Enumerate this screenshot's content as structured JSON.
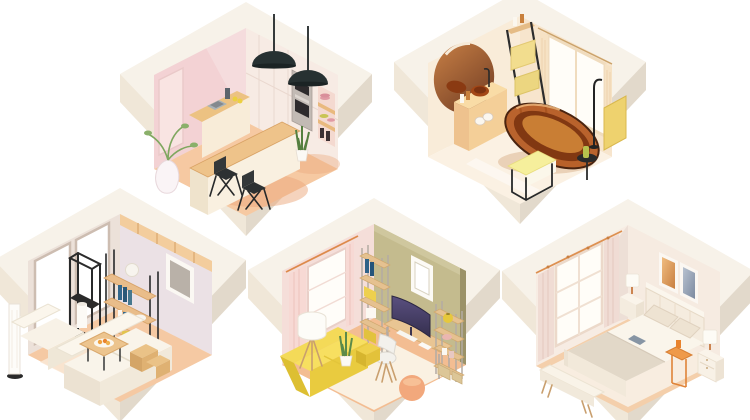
{
  "title": "Isometric hexagonal rooms illustration",
  "description": "Five low-poly isometric room interiors shown as hexagonal cut-away dioramas on a white background",
  "rooms": [
    {
      "id": "kitchen",
      "name": "Kitchen",
      "position": "top-left",
      "objects": [
        "pink-tiled-walls",
        "cream-cabinet-wall",
        "double-built-in-oven",
        "open-shelf-niche-with-plates",
        "sink-counter",
        "kitchen-island-bar",
        "black-pendant-lamps",
        "black-bar-stools",
        "white-floor-vase-with-plant",
        "potted-snake-plant"
      ]
    },
    {
      "id": "bathroom",
      "name": "Bathroom",
      "position": "top-right",
      "objects": [
        "round-mirror",
        "floating-vanity-with-amber-vessel-sink",
        "amber-glass-freestanding-bathtub",
        "black-freestanding-faucet",
        "ladder-towel-rack-with-yellow-towels",
        "bench-with-yellow-cushion",
        "window-with-cream-curtains",
        "yellow-screen-panel",
        "side-table-with-bottle"
      ]
    },
    {
      "id": "living-room",
      "name": "Living room",
      "position": "bottom-left",
      "objects": [
        "floor-to-ceiling-windows",
        "wood-plank-ceiling-band",
        "white-sectional-sofa",
        "coffee-table-with-fruit-plate",
        "black-etagere-with-vase",
        "wood-bookshelf-with-books",
        "white-column-floor-lamp",
        "wall-picture-frame",
        "wood-side-cubes",
        "rug"
      ]
    },
    {
      "id": "home-office",
      "name": "Home office",
      "position": "bottom-center",
      "objects": [
        "window-with-pink-curtains",
        "olive-wall",
        "picture-frame",
        "ladder-shelf-left",
        "desk-with-curved-monitor",
        "white-shell-chair",
        "ladder-shelf-right-with-vase-and-boxes",
        "yellow-sofa",
        "tripod-floor-lamp",
        "snake-plant",
        "yellow-crates",
        "peach-pouf",
        "rug"
      ]
    },
    {
      "id": "bedroom",
      "name": "Bedroom",
      "position": "bottom-right",
      "objects": [
        "window-with-curtains",
        "curtain-rod",
        "double-bed-with-headboard",
        "pillows",
        "beige-blanket",
        "book-on-bed",
        "back-nightstand-with-lamp",
        "front-nightstand-with-lamp",
        "orange-side-table-with-tray",
        "foot-bench",
        "warm-wall-art",
        "cool-wall-art",
        "rug"
      ]
    }
  ],
  "palette": {
    "background": "#ffffff",
    "outer_wall": "#f7f2e9",
    "outer_wall_shade_left": "#f0e7d8",
    "outer_wall_shade_right": "#e2d9cb",
    "kitchen_wall_pink": "#f3d2d4",
    "kitchen_cabinet": "#f7ebe4",
    "kitchen_floor": "#f6c9a2",
    "wood": "#e9bd8a",
    "black_metal": "#2b2f30",
    "oven_steel": "#c2bab4",
    "bathroom_wall": "#f9ecd9",
    "bathroom_floor": "#fbf1e3",
    "amber_glass": "#b4581f",
    "amber_dark": "#813812",
    "towel_yellow": "#f2dd8e",
    "cushion_yellow": "#f6ef9c",
    "living_wall_left": "#ece1d9",
    "living_wall_right": "#ebe1e5",
    "sofa_cream": "#f9f4ea",
    "rug_cream": "#f9e7d4",
    "office_wall_olive": "#c4bb8e",
    "office_curtain_pink": "#f7d9d4",
    "sofa_yellow": "#f4da58",
    "monitor_screen": "#3b3557",
    "pouf_peach": "#f2a87c",
    "crate_yellow": "#efd14c",
    "bedroom_wall": "#f7ece3",
    "bedroom_curtain": "#f0dcd4",
    "blanket_beige": "#e2d8c8",
    "accent_orange": "#ef9a4a",
    "art_warm": "#e0a061",
    "art_cool": "#97a4b6",
    "floor_peach": "#f4c49c"
  }
}
